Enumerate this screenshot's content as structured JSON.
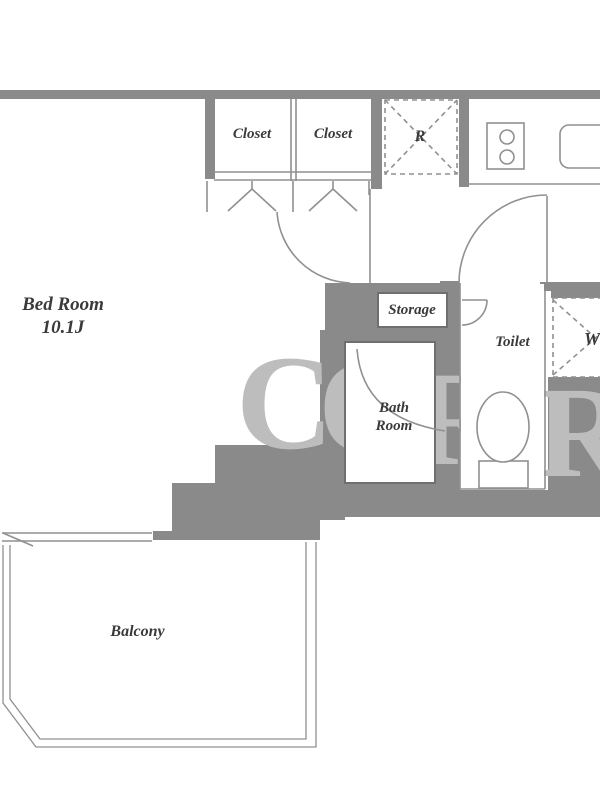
{
  "plan_title": "Apartment floor plan",
  "rooms": {
    "bedroom": {
      "label": "Bed Room",
      "size": "10.1J"
    },
    "closet_left": {
      "label": "Closet"
    },
    "closet_right": {
      "label": "Closet"
    },
    "refrigerator": {
      "label": "R"
    },
    "storage": {
      "label": "Storage"
    },
    "toilet": {
      "label": "Toilet"
    },
    "bathroom": {
      "label": "Bath Room"
    },
    "washer": {
      "label": "W"
    },
    "balcony": {
      "label": "Balcony"
    }
  },
  "watermark": {
    "l1": "C",
    "l2": "O",
    "l3": "R",
    "l4": "R"
  },
  "colors": {
    "wall": "#8a8a8a",
    "thin_line": "#909090",
    "room_border": "#6f6f6f",
    "text": "#3a3a3a",
    "watermark": "#bdbdbd",
    "background": "#ffffff"
  }
}
